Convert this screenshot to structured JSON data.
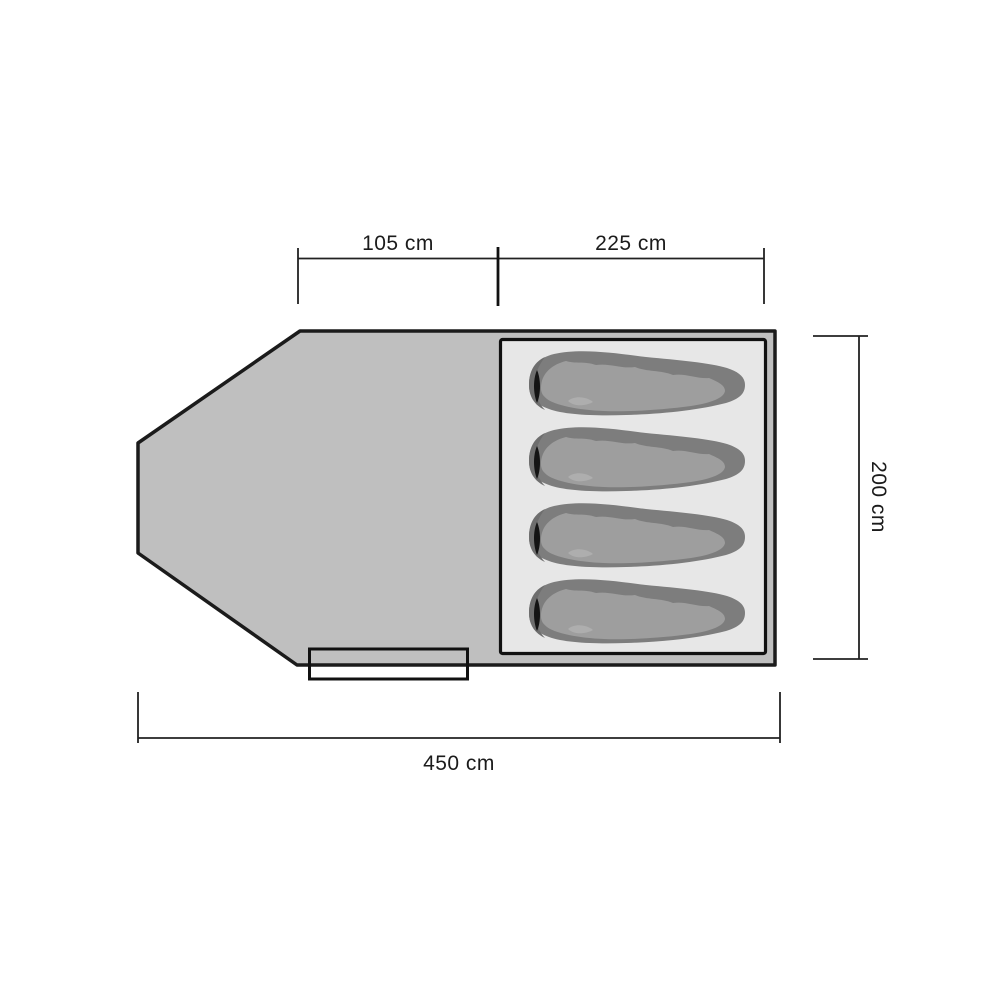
{
  "page": {
    "background": "#ffffff",
    "description": "Tent floor plan top view with four sleeping bags and dimension lines"
  },
  "dimensions": {
    "porch_length_label": "105 cm",
    "sleeping_area_length_label": "225 cm",
    "tent_width_label": "200 cm",
    "tent_total_length_label": "450 cm"
  },
  "diagram": {
    "sleeping_bag_count": 4,
    "colors": {
      "tent_fill": "#bfbfbf",
      "inner_fill": "#e7e7e7",
      "bag_dark": "#7d7d7d",
      "bag_darker": "#6e6e6e",
      "bag_mid": "#9e9e9e",
      "bag_light": "#aeaeae",
      "bag_slit": "#141414",
      "outline": "#1a1a1a"
    }
  }
}
